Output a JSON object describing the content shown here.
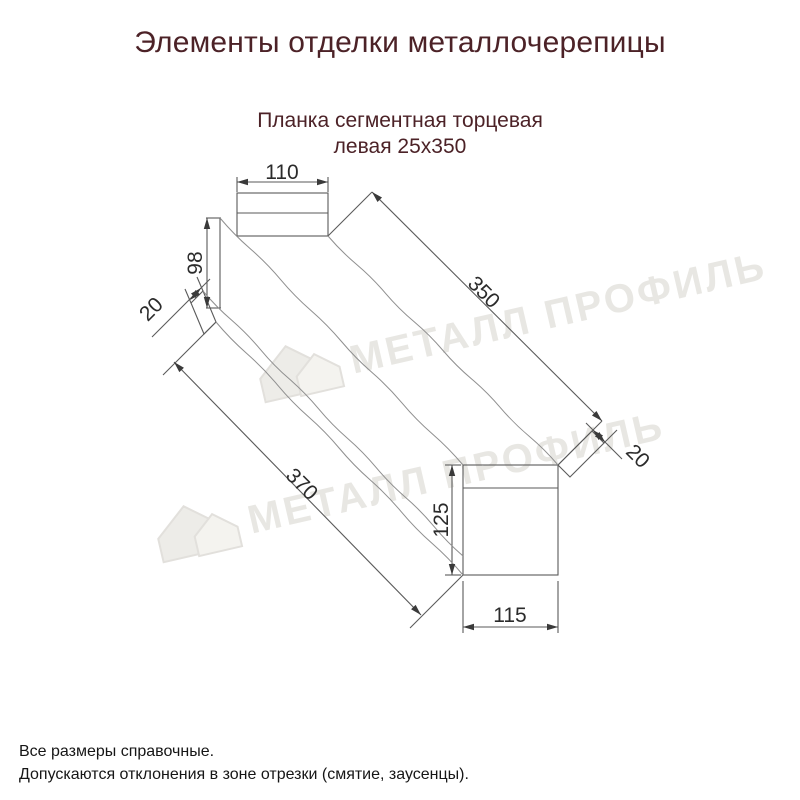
{
  "title": "Элементы отделки металлочерепицы",
  "subtitle": {
    "line1": "Планка сегментная торцевая",
    "line2": "левая 25х350"
  },
  "drawing": {
    "description": "Технический чертёж планки с размерами",
    "dimensions": {
      "top_width": "110",
      "left_height": "98",
      "left_hem": "20",
      "top_length": "350",
      "bottom_length": "370",
      "right_height": "125",
      "right_width": "115",
      "right_hem": "20"
    }
  },
  "watermark": {
    "text": "МЕТАЛЛ ПРОФИЛЬ"
  },
  "footer": {
    "line1": "Все размеры справочные.",
    "line2": "Допускаются отклонения в зоне отрезки (смятие, заусенцы)."
  },
  "colors": {
    "heading": "#4c2227",
    "line": "#5a5a5a",
    "wavy_line": "#8f8f8f",
    "dim_text": "#2b2b2b",
    "watermark": "#e8e7e3",
    "watermark_fill": "#edece8",
    "footer_text": "#161616"
  }
}
